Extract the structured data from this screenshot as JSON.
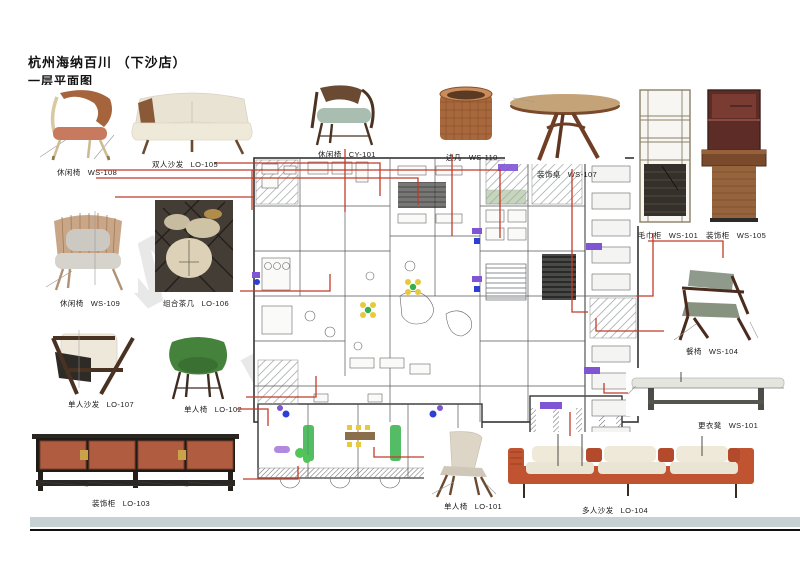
{
  "title": {
    "project": "杭州海纳百川 （下沙店）",
    "sheet": "一层平面图"
  },
  "watermark": {
    "letters": [
      "w",
      "m",
      "m"
    ]
  },
  "palette": {
    "callout_red": "#c23b2a",
    "marker_purple": "#8055d4",
    "marker_blue": "#2e3fd4",
    "marker_green": "#35b04a",
    "marker_yellow": "#e8c93e",
    "marker_cyan": "#6fd4c8",
    "cabinet_terracotta": "#b05c40",
    "sofa_red": "#c05430",
    "footer_band": "#c6d1d3"
  },
  "furniture": [
    {
      "label": "休闲椅",
      "code": "WS-108"
    },
    {
      "label": "双人沙发",
      "code": "LO-105"
    },
    {
      "label": "休闲椅",
      "code": "CY-101"
    },
    {
      "label": "边几",
      "code": "WS-110"
    },
    {
      "label": "装饰桌",
      "code": "WS-107"
    },
    {
      "label": "毛巾柜",
      "code": "WS-101"
    },
    {
      "label": "装饰柜",
      "code": "WS-105"
    },
    {
      "label": "休闲椅",
      "code": "WS-109"
    },
    {
      "label": "组合茶几",
      "code": "LO-106"
    },
    {
      "label": "餐椅",
      "code": "WS-104"
    },
    {
      "label": "单人沙发",
      "code": "LO-107"
    },
    {
      "label": "单人椅",
      "code": "LO-102"
    },
    {
      "label": "装饰柜",
      "code": "LO-103"
    },
    {
      "label": "单人椅",
      "code": "LO-101"
    },
    {
      "label": "多人沙发",
      "code": "LO-104"
    },
    {
      "label": "更衣凳",
      "code": "WS-101"
    }
  ]
}
